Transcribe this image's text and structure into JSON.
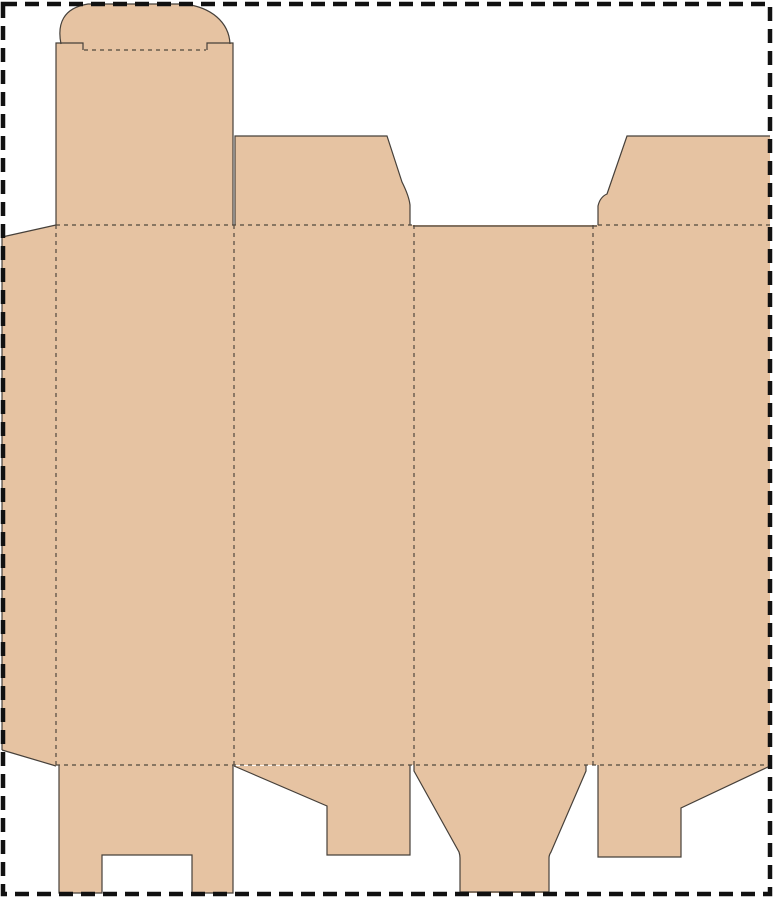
{
  "canvas": {
    "width": 773,
    "height": 900,
    "background": "#ffffff"
  },
  "palette": {
    "board_fill": "#e6c3a2",
    "cut_line": "#46403a",
    "fold_line": "#51473d",
    "border": "#111111"
  },
  "border": {
    "x": 3,
    "y": 4,
    "width": 767,
    "height": 890,
    "stroke_width": 4.5,
    "dash": "14 8"
  },
  "dieline": {
    "fills": [
      {
        "name": "glue-flap",
        "path": "M2,237 L56,225 L56,766 L2,750 Z"
      },
      {
        "name": "main-panels",
        "path": "M56,225 H770 V765 H56 Z"
      },
      {
        "name": "tuck-flap-panel",
        "path": "M56,43 H233 V225 H56 Z"
      },
      {
        "name": "tuck-tongue",
        "path": "M83,50 L61,44 C57,24 63,8 88,4 L184,4 C211,7 229,22 230,44 L207,50 Z"
      },
      {
        "name": "dust-flap-panel-2",
        "path": "M235,136 L387,136 L402,182 Q409,196 410,205 L410,225 L235,225 Z"
      },
      {
        "name": "dust-flap-panel-4",
        "path": "M627,136 L770,136 L770,225 L598,225 L598,206 Q600,197 607,194 Z"
      },
      {
        "name": "bottom-flap-panel-1",
        "path": "M59,765 H233 V893 H192 V855 H102 V893 H59 Z"
      },
      {
        "name": "bottom-flap-panel-2",
        "path": "M234,766 L327,806 L327,855 L410,855 L410,765 Z"
      },
      {
        "name": "bottom-flap-panel-3",
        "path": "M414,765 L414,771 L459,852 Q460,855 460,858 L460,893 L549,893 L549,858 Q549,855 551,852 L586,771 L586,765 Z"
      },
      {
        "name": "bottom-flap-panel-4",
        "path": "M598,765 L598,857 L681,857 L681,808 L770,766 L770,765 Z"
      }
    ],
    "cuts": [
      {
        "name": "glue-flap-top-cut",
        "path": "M2,237 L56,225"
      },
      {
        "name": "glue-flap-left-cut",
        "path": "M2,237 L2,750"
      },
      {
        "name": "glue-flap-bottom-cut",
        "path": "M2,750 L56,766"
      },
      {
        "name": "tuck-panel-left-cut",
        "path": "M56,225 L56,43 L83,43 L83,50"
      },
      {
        "name": "tuck-panel-right-cut",
        "path": "M207,50 L207,43 L233,43 L233,225"
      },
      {
        "name": "tuck-tongue-cut",
        "path": "M61,44 C57,24 63,8 88,4 L184,4 C211,7 229,22 230,44"
      },
      {
        "name": "dust-flap-2-cut",
        "path": "M235,225 L235,136 L387,136 L402,182 Q409,196 410,205 L410,225"
      },
      {
        "name": "panel-3-top-cut",
        "path": "M413,226 H597"
      },
      {
        "name": "dust-flap-4-cut",
        "path": "M598,225 L598,206 Q600,197 607,194 L627,136 L770,136"
      },
      {
        "name": "bottom-flap-1-cut",
        "path": "M59,765 L59,893 L102,893 L102,855 L192,855 L192,893 L233,893 L233,765"
      },
      {
        "name": "bottom-flap-2-cut",
        "path": "M234,766 L327,806 L327,855 L410,855 L410,765"
      },
      {
        "name": "bottom-flap-3-cut",
        "path": "M414,765 L414,771 L459,852 Q460,855 460,858 L460,892 L549,892 L549,858 Q549,855 551,852 L586,771 L586,765"
      },
      {
        "name": "bottom-flap-4-cut",
        "path": "M598,765 L598,857 L681,857 L681,808 L770,766"
      }
    ],
    "folds": [
      {
        "name": "glue-fold-vertical",
        "path": "M56,225 V765"
      },
      {
        "name": "panel-1-2-fold",
        "path": "M234,225 V765"
      },
      {
        "name": "panel-2-3-fold",
        "path": "M414,225 V765"
      },
      {
        "name": "panel-3-4-fold",
        "path": "M593,225 V765"
      },
      {
        "name": "top-fold-left-segment",
        "path": "M56,225 H412"
      },
      {
        "name": "top-fold-right-segment",
        "path": "M598,225 H770"
      },
      {
        "name": "bottom-fold",
        "path": "M56,765 H770"
      },
      {
        "name": "tuck-tongue-fold",
        "path": "M84,50 H206"
      }
    ]
  }
}
